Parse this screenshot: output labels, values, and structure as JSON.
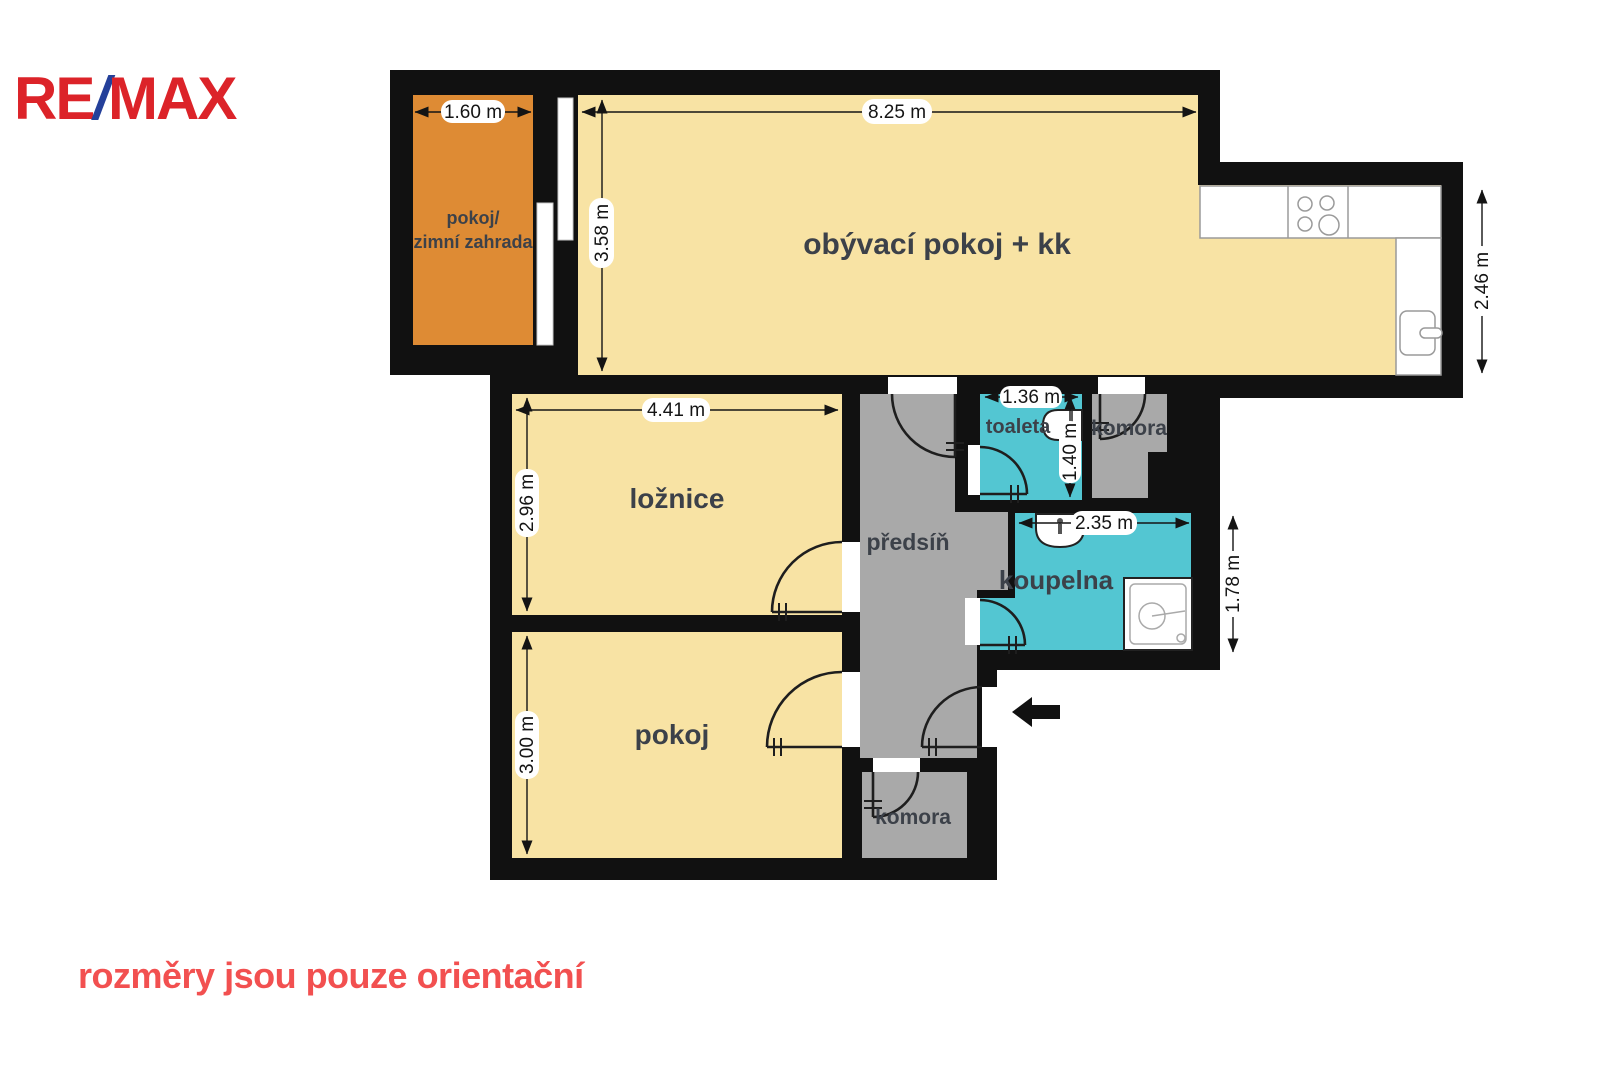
{
  "logo": {
    "re": "RE",
    "slash": "/",
    "max": "MAX"
  },
  "disclaimer": "rozměry jsou pouze orientační",
  "colors": {
    "wall": "#111111",
    "cream": "#f8e3a4",
    "orange": "#de8b34",
    "cyan": "#53c6d2",
    "gray": "#a9a9a9",
    "remax_red": "#dc2329",
    "remax_blue": "#24409a",
    "disclaimer_red": "#f25050",
    "label_gray": "#3c4149"
  },
  "rooms": {
    "winter_garden": {
      "label_line1": "pokoj/",
      "label_line2": "zimní zahrada",
      "width": "1.60 m"
    },
    "living_room": {
      "label": "obývací pokoj + kk",
      "width": "8.25 m",
      "depth": "3.58 m"
    },
    "kitchen": {
      "depth": "2.46 m"
    },
    "bedroom": {
      "label": "ložnice",
      "width": "4.41 m",
      "depth": "2.96 m"
    },
    "room": {
      "label": "pokoj",
      "depth": "3.00 m"
    },
    "hallway": {
      "label": "předsíň"
    },
    "toilet": {
      "label": "toaleta",
      "width": "1.36 m",
      "depth": "1.40 m"
    },
    "pantry_upper": {
      "label": "komora"
    },
    "bathroom": {
      "label": "koupelna",
      "width": "2.35 m",
      "depth": "1.78 m"
    },
    "pantry_lower": {
      "label": "komora"
    }
  }
}
